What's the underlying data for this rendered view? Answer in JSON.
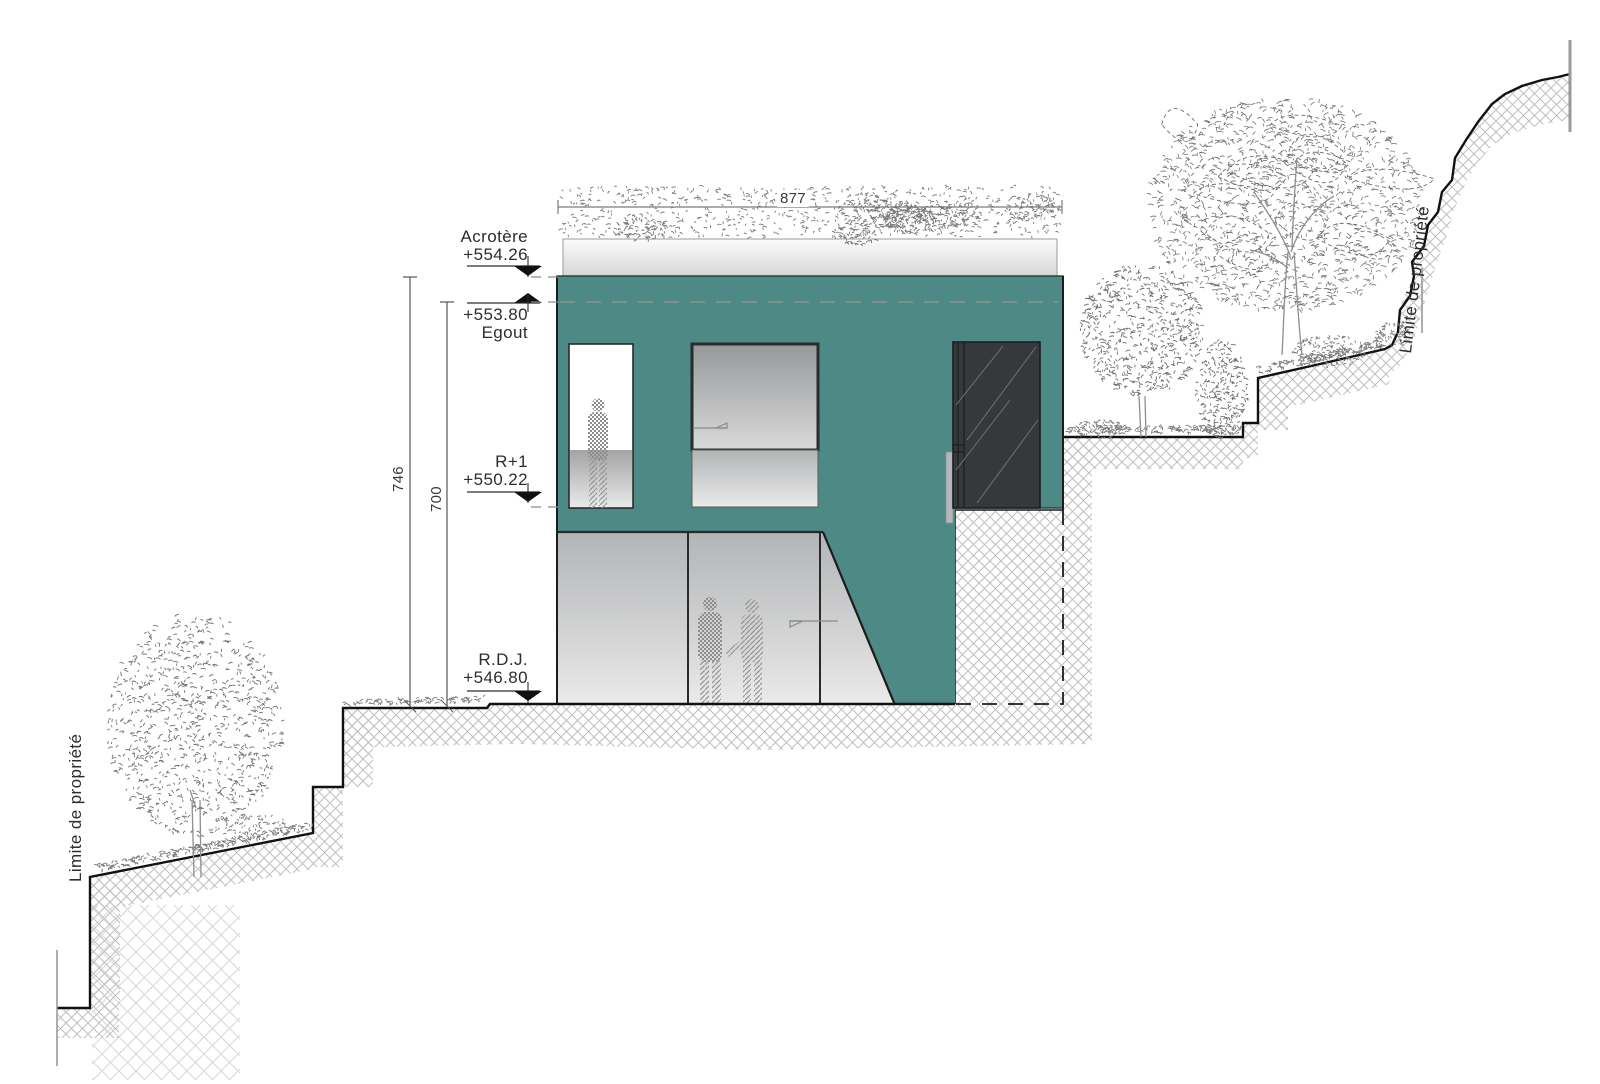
{
  "drawing": {
    "type": "facade-elevation-section",
    "levels": {
      "acrotere": {
        "label": "Acrotère",
        "value": "+554.26"
      },
      "egout": {
        "label": "Egout",
        "value": "+553.80"
      },
      "r1": {
        "label": "R+1",
        "value": "+550.22"
      },
      "rdj": {
        "label": "R.D.J.",
        "value": "+546.80"
      }
    },
    "dimensions": {
      "roof_width": "877",
      "height_total": "746",
      "height_to_egout": "700"
    },
    "property_limit_left": "Limite de propriété",
    "property_limit_right": "Limite de propriété",
    "colors": {
      "facade": "#4d8a85",
      "door": "#35393b",
      "parapet_light": "#fbfbfb",
      "parapet_dark": "#d7d7d7",
      "hatch": "#bfbfbf",
      "line": "#1c1c1c",
      "leader": "#8a8a8a"
    }
  }
}
